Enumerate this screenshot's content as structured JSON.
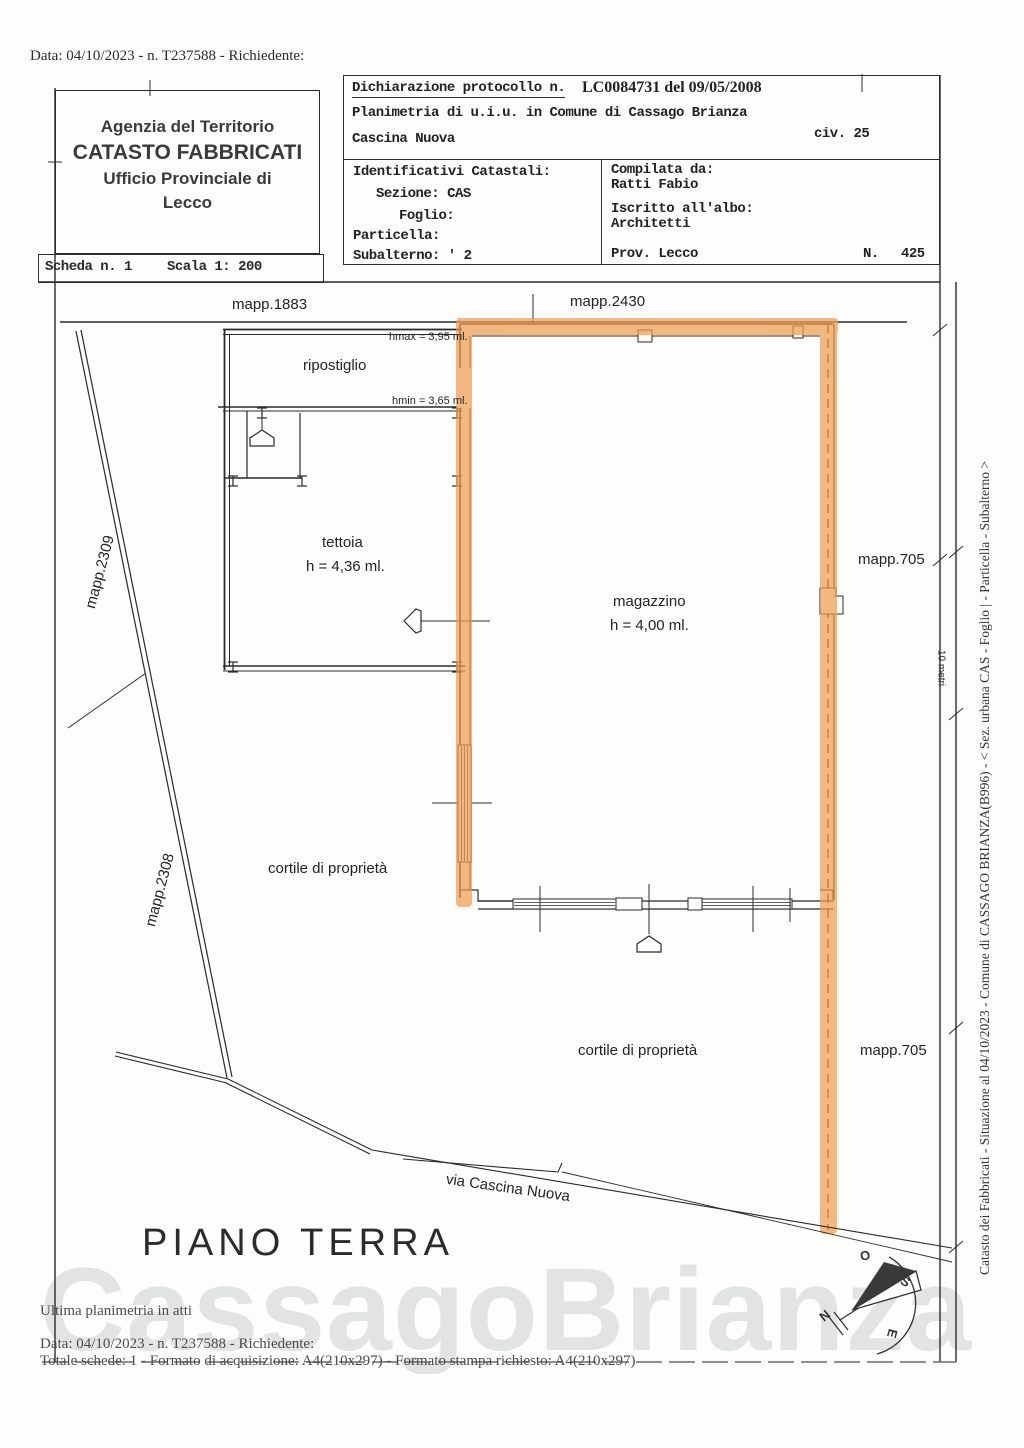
{
  "page": {
    "top_line": "Data: 04/10/2023 - n. T237588 - Richiedente:",
    "watermark": "CassagoBrianza"
  },
  "header": {
    "line1": "Agenzia del Territorio",
    "line2": "CATASTO FABBRICATI",
    "line3": "Ufficio Provinciale di",
    "line4": "Lecco"
  },
  "scheda": {
    "scheda": "Scheda n. 1",
    "scala": "Scala 1: 200"
  },
  "declaration": {
    "protocollo_label": "Dichiarazione protocollo n.",
    "protocollo_value": "LC0084731 del  09/05/2008",
    "planimetria": "Planimetria di u.i.u. in Comune di Cassago Brianza",
    "localita": "Cascina Nuova",
    "civico": "civ. 25",
    "identificativi_title": "Identificativi Catastali:",
    "sezione": "Sezione: CAS",
    "foglio": "Foglio:",
    "particella": "Particella:",
    "subalterno": "Subalterno: ' 2",
    "compilata_label": "Compilata da:",
    "compilata_nome": "Ratti Fabio",
    "albo_label": "Iscritto all'albo:",
    "albo_valore": "Architetti",
    "prov": "Prov. Lecco",
    "n_label": "N.",
    "n_valore": "425"
  },
  "plan": {
    "mapp_1883": "mapp.1883",
    "mapp_2430": "mapp.2430",
    "mapp_2309": "mapp.2309",
    "mapp_2308": "mapp.2308",
    "mapp_705_upper": "mapp.705",
    "mapp_705_lower": "mapp.705",
    "ripostiglio": "ripostiglio",
    "hmax": "hmax = 3,95 ml.",
    "hmin": "hmin = 3,65 ml.",
    "tettoia": "tettoia",
    "tettoia_h": "h = 4,36 ml.",
    "magazzino": "magazzino",
    "magazzino_h": "h = 4,00 ml.",
    "cortile_upper": "cortile di proprietà",
    "cortile_lower": "cortile di proprietà",
    "via": "via Cascina Nuova",
    "piano": "PIANO TERRA",
    "scale_note": "10 metri",
    "compass": {
      "n": "N",
      "o": "O",
      "s": "S",
      "e": "E"
    }
  },
  "margin_right": {
    "text": "Catasto dei Fabbricati - Situazione al 04/10/2023 - Comune di CASSAGO BRIANZA(B996) - < Sez. urbana CAS -  Foglio | - Particella    - Subalterno    >"
  },
  "footer": {
    "line1": "Ultima planimetria in atti",
    "line2": "Data: 04/10/2023 - n. T237588 - Richiedente:",
    "line3": "Totale schede: 1 - Formato di acquisizione: A4(210x297)  - Formato stampa richiesto: A4(210x297)"
  },
  "colors": {
    "highlight": "#ee9d4e",
    "ink": "#2a2a2a"
  }
}
